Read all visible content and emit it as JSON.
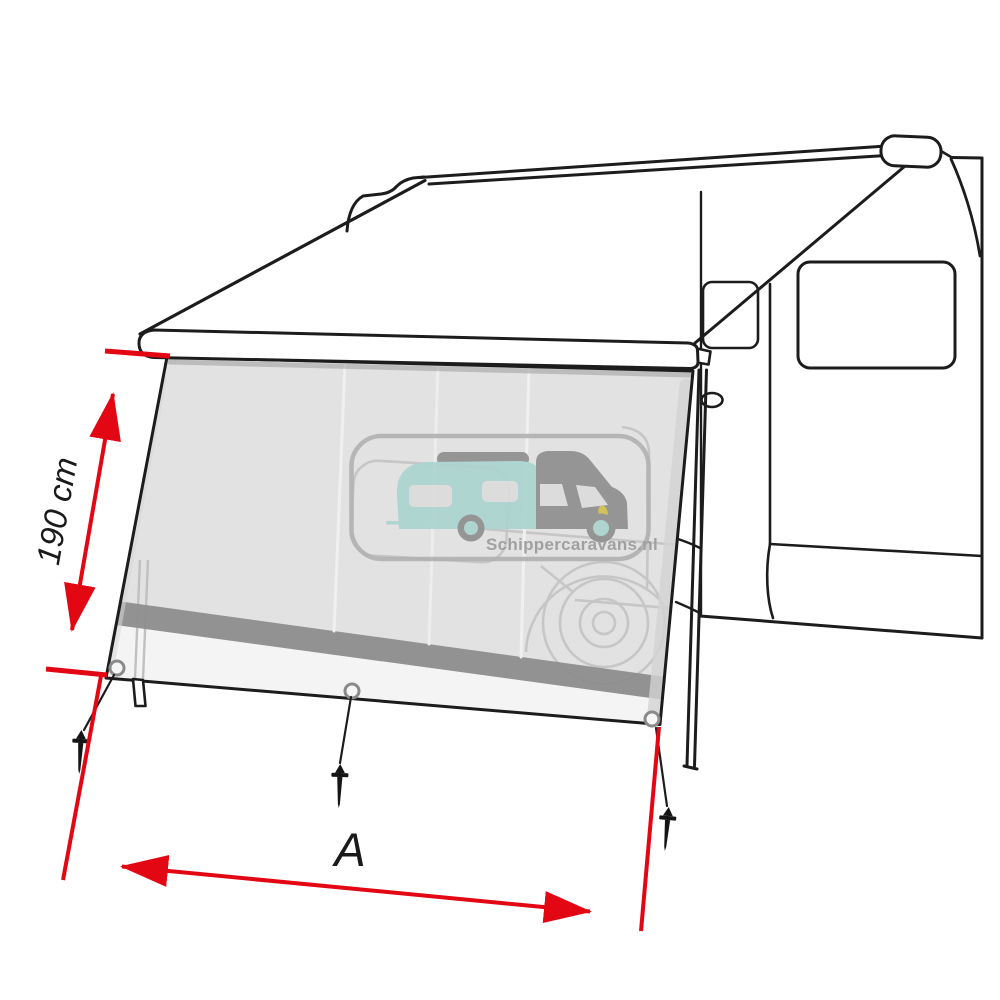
{
  "diagram": {
    "type": "awning-front-panel-dimension-diagram",
    "subject": "Sun view front panel hanging from a campervan awning with ground pegs",
    "dimensions": {
      "height": {
        "label": "190 cm"
      },
      "width": {
        "label": "A"
      }
    },
    "watermark": {
      "text": "Schippercaravans.nl"
    },
    "counts": {
      "grommets": 3,
      "ground_pegs": 3,
      "support_legs": 2
    },
    "colors": {
      "dimension_red": "#e30613",
      "outline_black": "#1c1c1c",
      "panel_gray": "#e2e2e2",
      "panel_bottom_strip": "#f4f4f4",
      "panel_dark_stripe": "#8d8d8d",
      "ghost_line_gray": "#c6c6c6",
      "watermark_gray": "#9b9b9b",
      "watermark_teal": "#abd4d0",
      "watermark_cab_gray": "#8f8f8f",
      "watermark_headlight_yellow": "#d2c14b"
    }
  }
}
